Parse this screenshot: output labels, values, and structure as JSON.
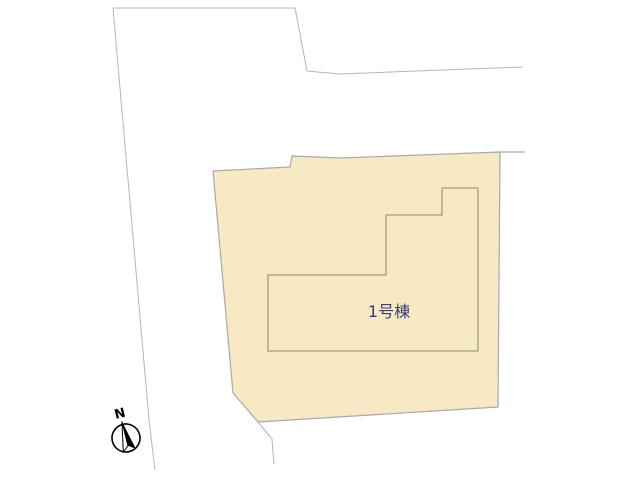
{
  "plan": {
    "building_label": "1号棟",
    "compass_label": "N"
  },
  "colors": {
    "background": "#ffffff",
    "parcel_fill": "#f8e9c5",
    "parcel_stroke": "#a9a9a9",
    "building_stroke": "#a59c82",
    "road_stroke": "#b5b5b5",
    "label_color": "#3c3c6e",
    "compass_color": "#000000"
  },
  "geometry": {
    "road_top_points": "113,8 295,8 307,71 340,74 523,67",
    "road_left_points": "113,8 149,420 155,470",
    "road_bottom_points": "258,422 272,439 274,464",
    "parcel_edge_ext_points": "500,152 525,152",
    "parcel_points": "213,171 290,167 292,156 340,158 500,152 498,407 258,422 233,393",
    "building_points": "268,275 386,275 386,215 442,215 442,188 478,188 478,351 268,351",
    "compass_needle_left": "M0,-17 L-6,13 L0,8 Z",
    "compass_needle_right": "M0,-17 L7,13 L0,8 Z"
  }
}
